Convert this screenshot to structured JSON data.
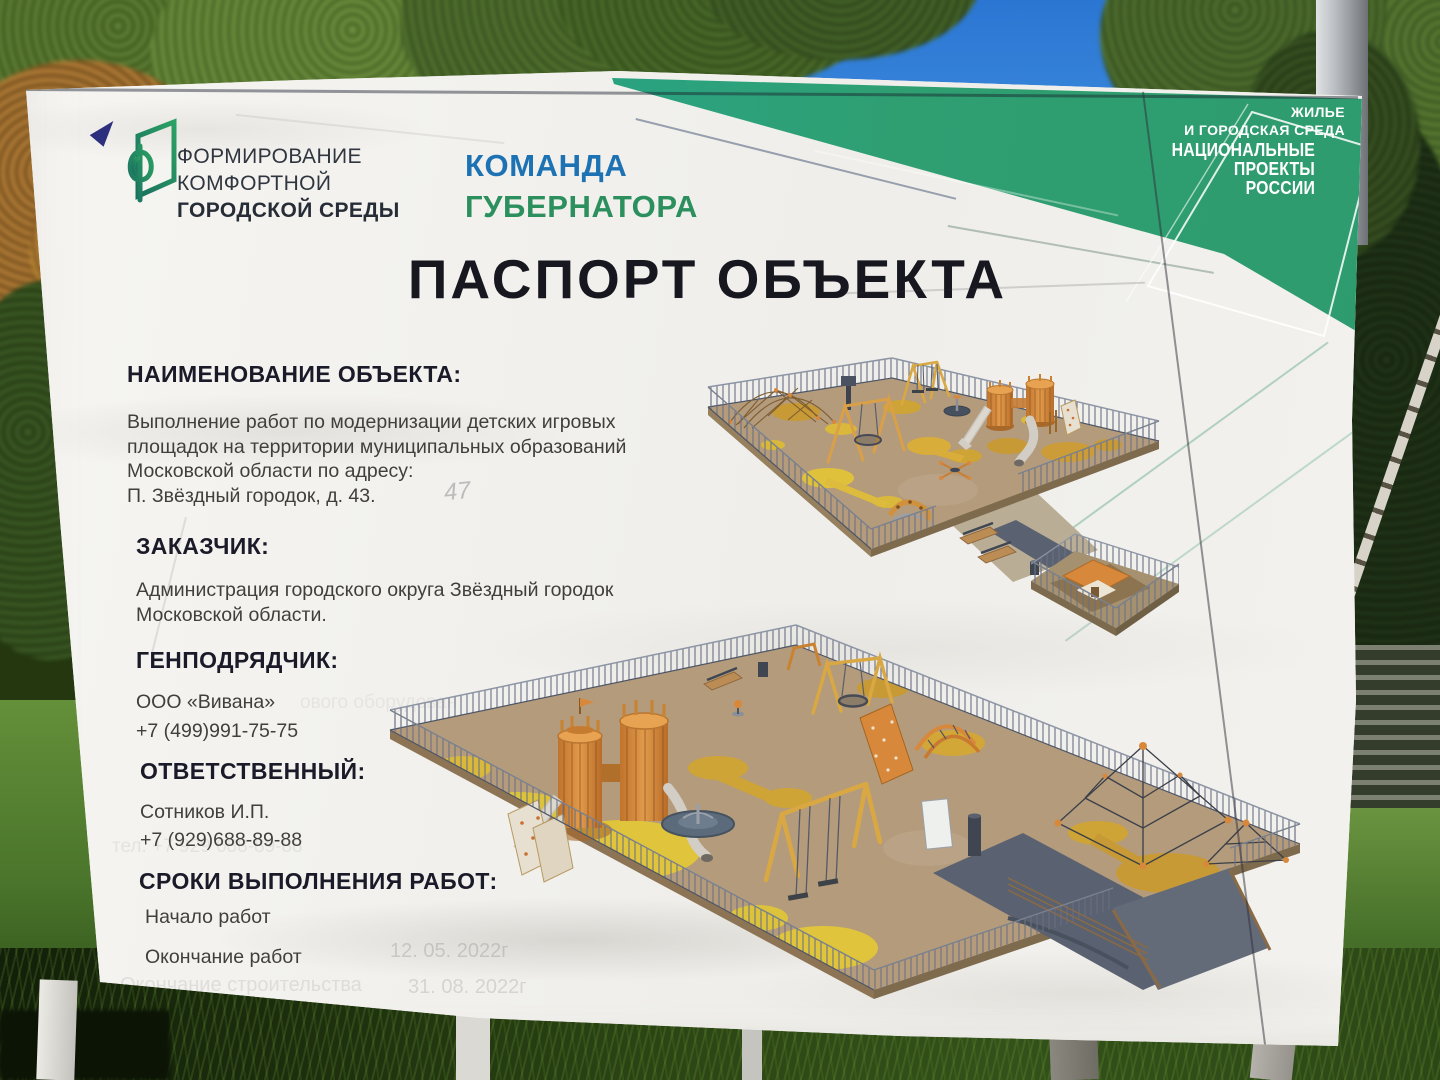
{
  "sign": {
    "program_logo": {
      "icon": "fkgs-logo-mark",
      "line1": "ФОРМИРОВАНИЕ",
      "line2": "КОМФОРТНОЙ",
      "line3": "ГОРОДСКОЙ СРЕДЫ"
    },
    "governor_team": {
      "line1": "КОМАНДА",
      "line2": "ГУБЕРНАТОРА"
    },
    "national_projects": {
      "sector_line1": "ЖИЛЬЕ",
      "sector_line2": "И ГОРОДСКАЯ СРЕДА",
      "brand_line1": "НАЦИОНАЛЬНЫЕ",
      "brand_line2": "ПРОЕКТЫ",
      "brand_line3": "РОССИИ"
    },
    "title": "ПАСПОРТ ОБЪЕКТА",
    "sections": [
      {
        "heading": "НАИМЕНОВАНИЕ ОБЪЕКТА:",
        "lines": [
          "Выполнение работ по модернизации детских игровых",
          "площадок на территории муниципальных образований",
          "Московской области по адресу:",
          "П. Звёздный городок, д. 43."
        ]
      },
      {
        "heading": "ЗАКАЗЧИК:",
        "lines": [
          "Администрация городского округа Звёздный городок",
          "Московской области."
        ]
      },
      {
        "heading": "ГЕНПОДРЯДЧИК:",
        "lines": [
          "ООО «Вивана»",
          "+7 (499)991-75-75"
        ]
      },
      {
        "heading": "ОТВЕТСТВЕННЫЙ:",
        "lines": [
          "Сотников И.П.",
          "+7 (929)688-89-88"
        ]
      },
      {
        "heading": "СРОКИ ВЫПОЛНЕНИЯ РАБОТ:",
        "lines": [
          "Начало работ",
          "Окончание работ"
        ]
      }
    ],
    "ghost_text": {
      "start_date": "12. 05. 2022г",
      "end_label": "Окончание строительства",
      "end_date": "31. 08. 2022г",
      "phone": "тел. +7 929 688-89-88",
      "equipment_fragment": "ового оборудован",
      "handwritten_house_number": "47"
    },
    "colors": {
      "banner_green": "#2f9e6f",
      "banner_blue": "#1f8ecb",
      "governor_blue": "#1d72b4",
      "governor_green": "#2c8f5e",
      "heading_dark": "#1a1a29",
      "playground_orange": "#d8883a",
      "surface_tan": "#b49b7c",
      "accent_yellow": "#e0c43c"
    }
  }
}
